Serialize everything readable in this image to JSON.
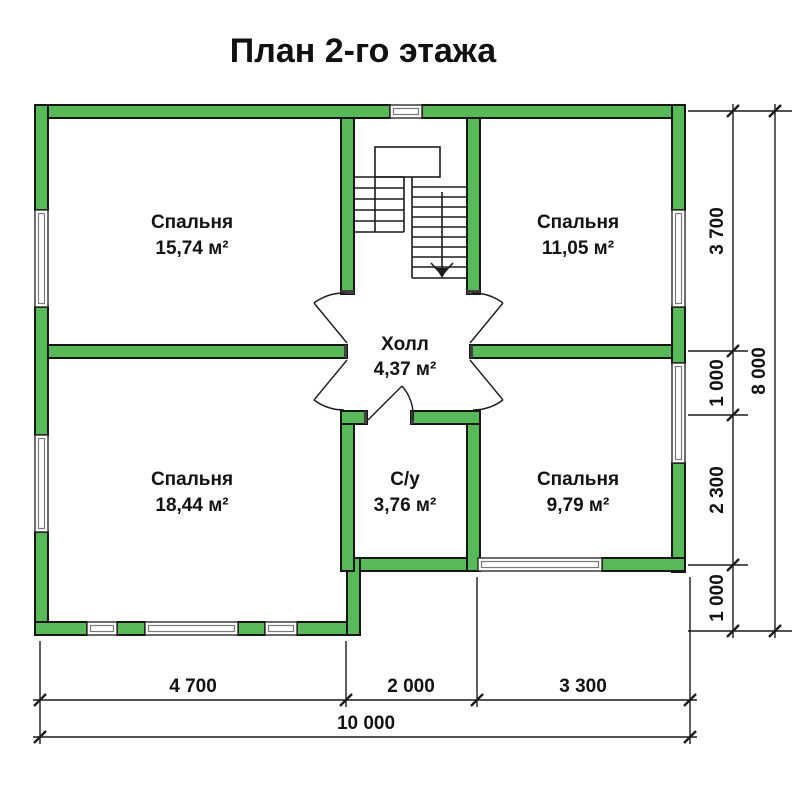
{
  "title": "План 2-го этажа",
  "colors": {
    "wall_fill": "#58b958",
    "wall_outline": "#161616",
    "line": "#1c1c1c",
    "window_frame": "#7a7a7a"
  },
  "rooms": [
    {
      "id": "bedroom-top-left",
      "name": "Спальня",
      "area": "15,74 м²"
    },
    {
      "id": "bedroom-top-right",
      "name": "Спальня",
      "area": "11,05 м²"
    },
    {
      "id": "hall",
      "name": "Холл",
      "area": "4,37 м²"
    },
    {
      "id": "bedroom-bottom-left",
      "name": "Спальня",
      "area": "18,44 м²"
    },
    {
      "id": "bathroom",
      "name": "С/у",
      "area": "3,76 м²"
    },
    {
      "id": "bedroom-bottom-right",
      "name": "Спальня",
      "area": "9,79 м²"
    }
  ],
  "dimensions": {
    "right": [
      "3 700",
      "1 000",
      "2 300",
      "1 000"
    ],
    "right_total": "8 000",
    "bottom": [
      "4 700",
      "2 000",
      "3 300"
    ],
    "bottom_total": "10 000"
  }
}
